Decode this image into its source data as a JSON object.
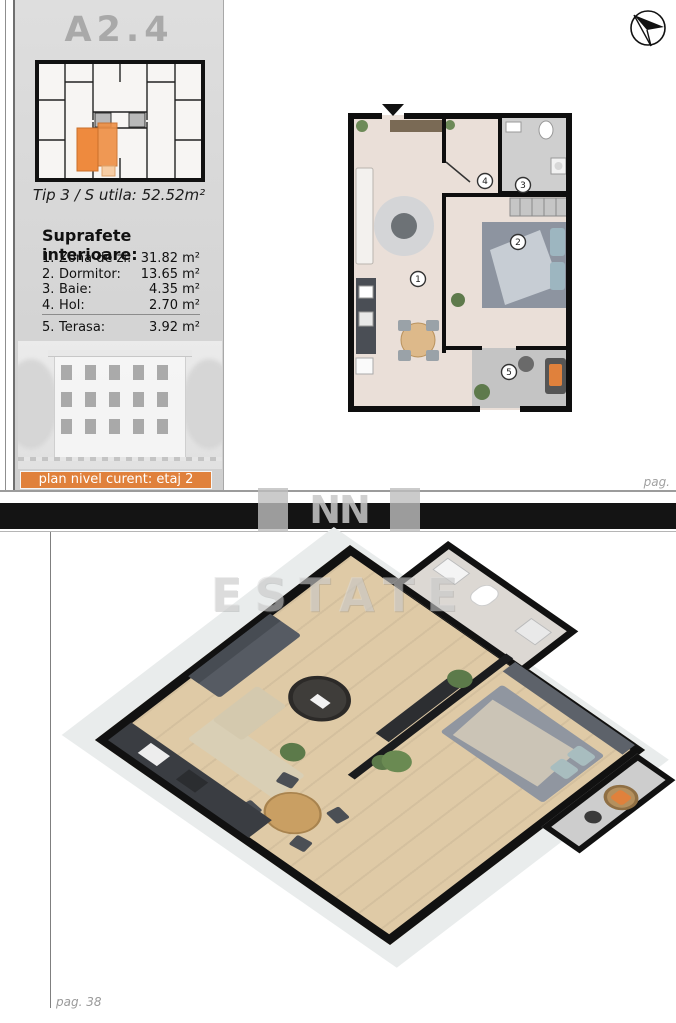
{
  "sidebar": {
    "unit_code": "A2.4",
    "type_line": "Tip 3 / S utila: 52.52m²",
    "sections_title": "Suprafete interioare:",
    "rooms": [
      {
        "num": "1.",
        "name": "Zona de zi:",
        "area": "31.82 m²"
      },
      {
        "num": "2.",
        "name": "Dormitor:",
        "area": "13.65 m²"
      },
      {
        "num": "3.",
        "name": "Baie:",
        "area": "4.35 m²"
      },
      {
        "num": "4.",
        "name": "Hol:",
        "area": "2.70 m²"
      }
    ],
    "terrace_row": {
      "num": "5.",
      "name": "Terasa:",
      "area": "3.92 m²"
    },
    "level_bar_label": "plan nivel curent: etaj 2"
  },
  "plan2d": {
    "room_labels": [
      "1",
      "2",
      "3",
      "4",
      "5"
    ]
  },
  "footer": {
    "page_label_top": "pag.",
    "page_label_bottom": "pag. 38"
  },
  "watermark": {
    "logo_text": "NN",
    "text": "ESTATE"
  },
  "colors": {
    "accent_orange": "#e0813c",
    "unit_orange": "#ee8a3e",
    "unit_orange_light": "#f7cda4",
    "bar_black": "#141414",
    "floor_beige": "#eadfd8",
    "wood": "#dfcaa6",
    "wall_black": "#0e0e0e"
  }
}
